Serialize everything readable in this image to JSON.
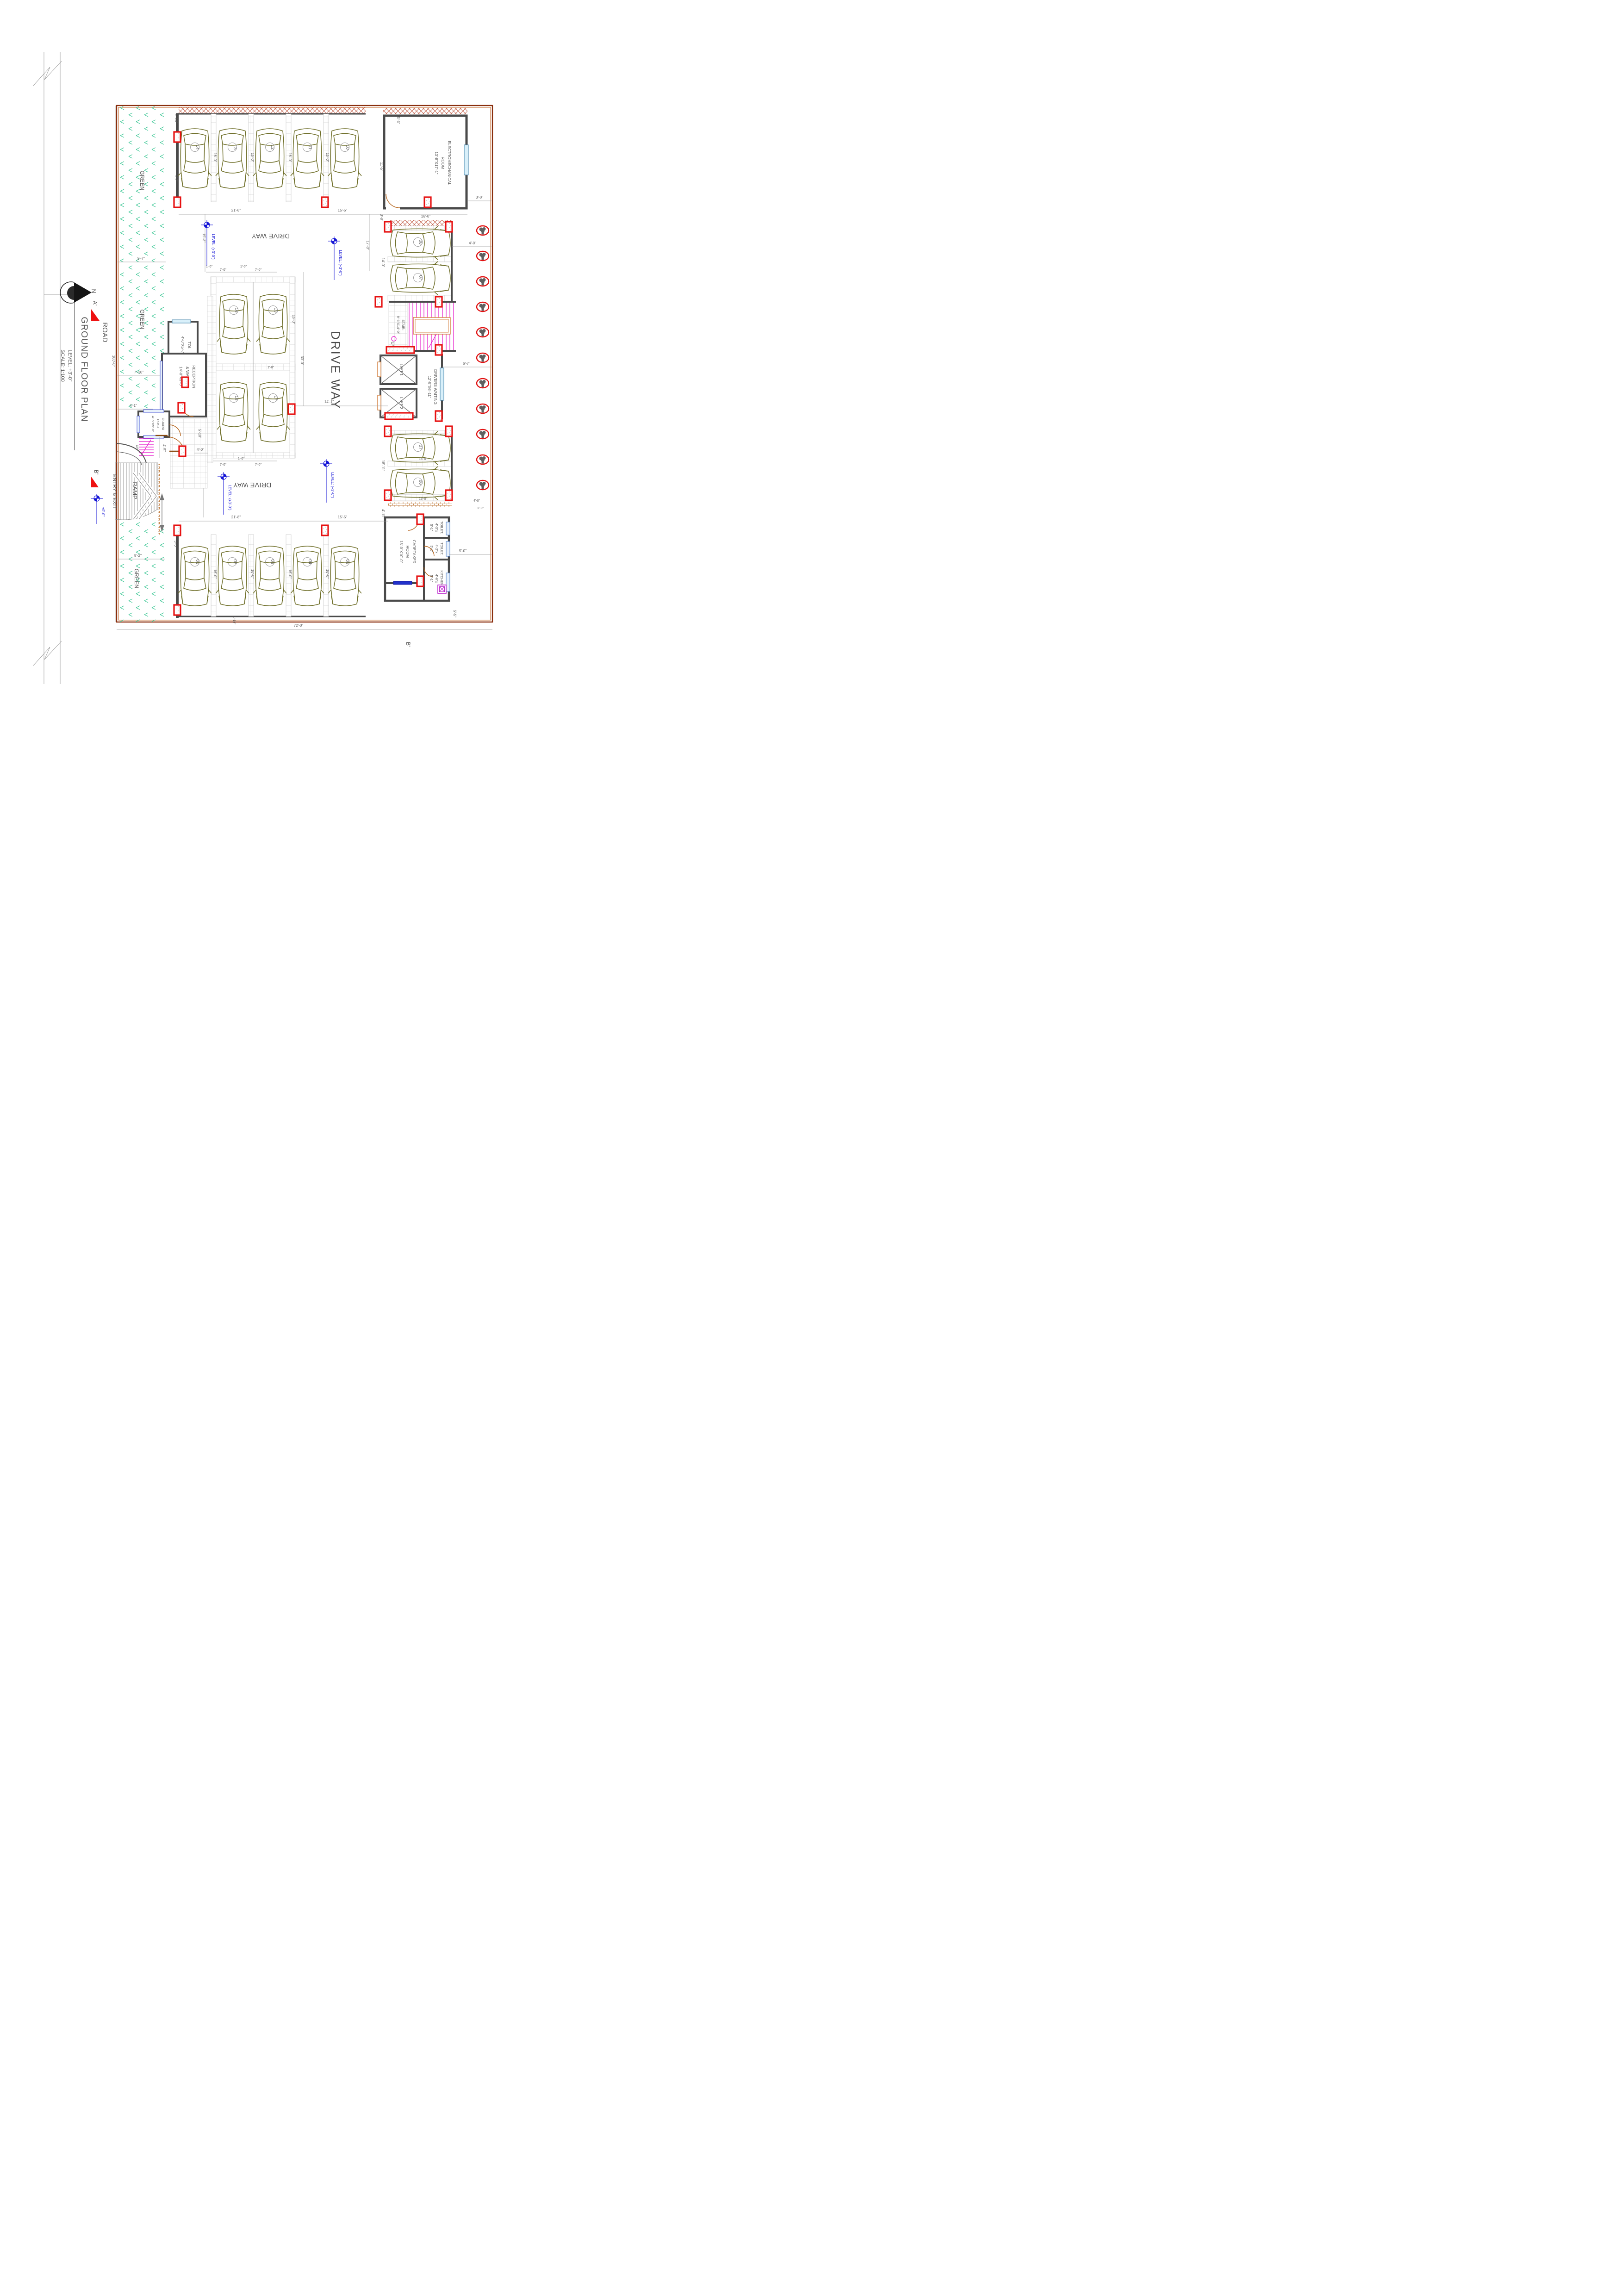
{
  "sheet": {
    "road": "ROAD",
    "north": "N",
    "title": "GROUND  FLOOR PLAN",
    "level": "LEVEL: +3'-0\"",
    "scale": "SCALE: 1:100"
  },
  "markers": {
    "a": "A'",
    "b": "B'"
  },
  "levels": {
    "plan": "LEVEL: (+3'-0\")",
    "entry": "±0'-0\""
  },
  "areas": {
    "green": "GREEN",
    "driveway": "DRIVE WAY",
    "ramp": "RAMP",
    "entry_exit": "ENTRY & EXIT"
  },
  "rooms": {
    "electromechanical": {
      "name": "ELECTROMECHANICAL",
      "name2": "ROOM",
      "size": "13'-8\"X17'-1\""
    },
    "stair": {
      "name": "STAIR:",
      "size": "9'-5\"X14'-0\"",
      "up": "UP"
    },
    "lift1": {
      "name": "LIFT:1"
    },
    "lift2": {
      "name": "LIFT:2"
    },
    "drivers_waiting": {
      "name": "DRIVERS WAITING",
      "size": "12'-5\"X6'-11\""
    },
    "caretaker": {
      "name": "CARETAKER",
      "name2": "ROOM",
      "size": "13'-0\"X10'-0\""
    },
    "toilet1": {
      "name": "TOILET.",
      "size": "4'-3\"x",
      "size2": "5'-1\""
    },
    "toilet2": {
      "name": "TOILET.",
      "size": "4'-2\"x",
      "size2": "5'-1\""
    },
    "kitchen": {
      "name": "KITCHEN.",
      "size": "4'-6\"x",
      "size2": "5'-1\""
    },
    "toi": {
      "name": "TOI.",
      "size": "4'-6\"X5'-7\""
    },
    "reception": {
      "name": "RECEPTION",
      "name2": "& WAITING",
      "size": "14'-0\"X9'-0\""
    },
    "guard": {
      "name": "GUARD",
      "name2": "POST",
      "size": "4'-6\"X5'-0\""
    }
  },
  "stalls": {
    "b1": "01",
    "b2": "02",
    "b3": "03",
    "b4": "04",
    "b5": "05",
    "t1": "14",
    "t2": "13",
    "t3": "12",
    "t4": "11",
    "t5": "10",
    "m1": "16",
    "m2": "15",
    "m3": "18",
    "m4": "17",
    "r1": "06",
    "r2": "07",
    "r3": "07",
    "r4": "06"
  },
  "dims": {
    "d16": "16'-0\"",
    "d110": "1'-10\"",
    "d17": "1'-7\"",
    "d218": "21'-8\"",
    "d155": "15'-5\"",
    "d55": "5'-5\"",
    "d115": "11'-5\"",
    "d30": "3'-0\"",
    "d38": "3'-8\"",
    "d153": "15'-3\"",
    "d178": "17'-8\"",
    "d140": "14'-0\"",
    "d40": "4'-0\"",
    "d67": "6'-7\"",
    "d97": "9'-7\"",
    "d710": "7'-10\"",
    "d41": "4'-1\"",
    "d82": "8'-2\"",
    "d10": "1'-0\"",
    "d70": "7'-0\"",
    "d330": "33'-0\"",
    "d141": "14'-1\"",
    "d510": "5'-10\"",
    "d45": "4'-5\"",
    "d1811": "18'-11\"",
    "d150": "15'-0\"",
    "d411": "4'-11\"",
    "d50": "5'-0\"",
    "d720": "72'-0\"",
    "d1000": "100'-0\""
  }
}
